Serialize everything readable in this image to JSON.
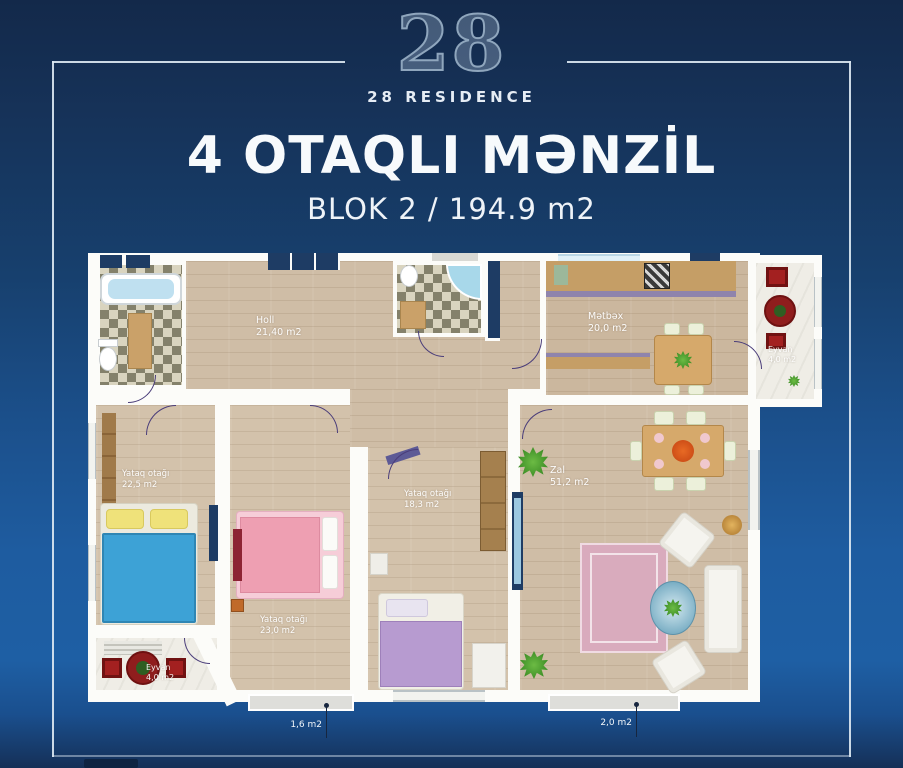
{
  "brand": {
    "logo_number": "28",
    "name": "28 RESIDENCE"
  },
  "header": {
    "title": "4 OTAQLI MƏNZİL",
    "subtitle": "BLOK 2 / 194.9 m2"
  },
  "plan": {
    "rooms": {
      "holl": {
        "name": "Holl",
        "area": "21,40 m2"
      },
      "metbex": {
        "name": "Mətbəx",
        "area": "20,0 m2"
      },
      "eyvan_right": {
        "name": "Eyvan",
        "area": "4,0 m2"
      },
      "yataq_left": {
        "name": "Yataq otağı",
        "area": "22,5 m2"
      },
      "yataq_mid": {
        "name": "Yataq otağı",
        "area": "23,0 m2"
      },
      "yataq_small": {
        "name": "Yataq otağı",
        "area": "18,3 m2"
      },
      "zal": {
        "name": "Zal",
        "area": "51,2 m2"
      },
      "eyvan_left": {
        "name": "Eyvan",
        "area": "4,0 m2"
      }
    },
    "measurements": {
      "left": "1,6 m2",
      "right": "2,0 m2"
    }
  },
  "colors": {
    "background_top": "#13294a",
    "background_bottom": "#1e5fa4",
    "frame": "#dbe7f1",
    "accent_red": "#9e1c1c",
    "wood_floor": "#cfbda6",
    "wall_white": "#fcfcf9"
  }
}
